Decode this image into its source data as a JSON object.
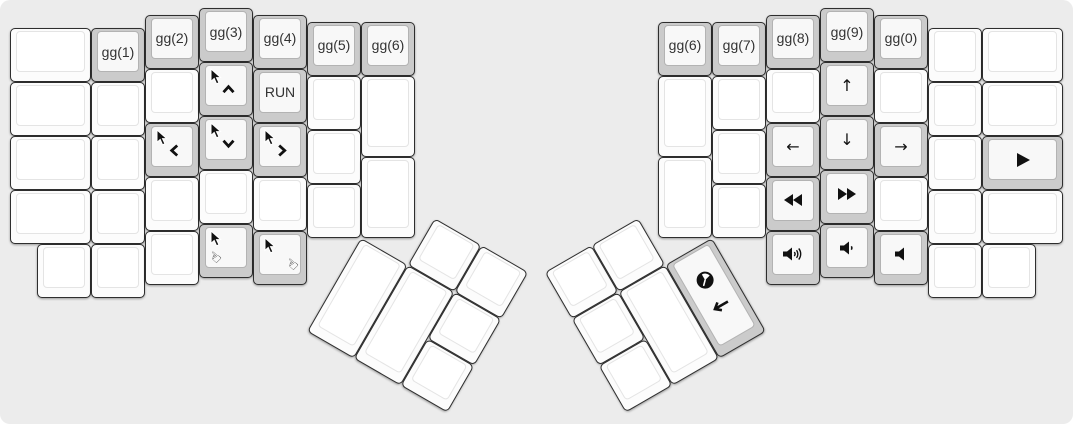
{
  "canvas": {
    "width": 1073,
    "height": 424,
    "background": "#ececec",
    "page_background": "#ffffff",
    "unit_px": 54,
    "origin_x": 10,
    "origin_y": 8,
    "colors": {
      "key_white": "#fcfcfc",
      "key_gray": "#cbcbcb",
      "key_border": "#2e2e2e",
      "legend": "#111111"
    }
  },
  "keys": [
    {
      "name": "blank",
      "x": 0,
      "y": 0.375,
      "w": 1.5,
      "color": "white"
    },
    {
      "name": "layer-gg1",
      "x": 1.5,
      "y": 0.375,
      "color": "gray",
      "label": "gg(1)"
    },
    {
      "name": "layer-gg2",
      "x": 2.5,
      "y": 0.125,
      "color": "gray",
      "label": "gg(2)"
    },
    {
      "name": "layer-gg3",
      "x": 3.5,
      "y": 0,
      "color": "gray",
      "label": "gg(3)"
    },
    {
      "name": "layer-gg4",
      "x": 4.5,
      "y": 0.125,
      "color": "gray",
      "label": "gg(4)"
    },
    {
      "name": "layer-gg5",
      "x": 5.5,
      "y": 0.25,
      "color": "gray",
      "label": "gg(5)"
    },
    {
      "name": "layer-gg6-left",
      "x": 6.5,
      "y": 0.25,
      "color": "gray",
      "label": "gg(6)"
    },
    {
      "name": "blank",
      "x": 0,
      "y": 1.375,
      "w": 1.5,
      "color": "white"
    },
    {
      "name": "blank",
      "x": 1.5,
      "y": 1.375,
      "color": "white"
    },
    {
      "name": "blank",
      "x": 2.5,
      "y": 1.125,
      "color": "white"
    },
    {
      "name": "mouse-up",
      "x": 3.5,
      "y": 1,
      "color": "gray",
      "legends": [
        {
          "icon": "mouse-cursor",
          "pos": "tl"
        },
        {
          "icon": "chevron-up",
          "pos": "mid"
        }
      ]
    },
    {
      "name": "run",
      "x": 4.5,
      "y": 1.125,
      "color": "gray",
      "label": "RUN"
    },
    {
      "name": "blank",
      "x": 5.5,
      "y": 1.25,
      "color": "white"
    },
    {
      "name": "blank",
      "x": 6.5,
      "y": 1.25,
      "h": 1.5,
      "color": "white"
    },
    {
      "name": "blank",
      "x": 0,
      "y": 2.375,
      "w": 1.5,
      "color": "white"
    },
    {
      "name": "blank",
      "x": 1.5,
      "y": 2.375,
      "color": "white"
    },
    {
      "name": "mouse-left",
      "x": 2.5,
      "y": 2.125,
      "color": "gray",
      "legends": [
        {
          "icon": "mouse-cursor",
          "pos": "tl"
        },
        {
          "icon": "chevron-left",
          "pos": "mid"
        }
      ]
    },
    {
      "name": "mouse-down",
      "x": 3.5,
      "y": 2,
      "color": "gray",
      "legends": [
        {
          "icon": "mouse-cursor",
          "pos": "tl"
        },
        {
          "icon": "chevron-down",
          "pos": "mid"
        }
      ]
    },
    {
      "name": "mouse-right",
      "x": 4.5,
      "y": 2.125,
      "color": "gray",
      "legends": [
        {
          "icon": "mouse-cursor",
          "pos": "tl"
        },
        {
          "icon": "chevron-right",
          "pos": "mid"
        }
      ]
    },
    {
      "name": "blank",
      "x": 5.5,
      "y": 2.25,
      "color": "white"
    },
    {
      "name": "blank",
      "x": 0,
      "y": 3.375,
      "w": 1.5,
      "color": "white"
    },
    {
      "name": "blank",
      "x": 1.5,
      "y": 3.375,
      "color": "white"
    },
    {
      "name": "blank",
      "x": 2.5,
      "y": 3.125,
      "color": "white"
    },
    {
      "name": "blank",
      "x": 3.5,
      "y": 3,
      "color": "white"
    },
    {
      "name": "blank",
      "x": 4.5,
      "y": 3.125,
      "color": "white"
    },
    {
      "name": "blank",
      "x": 5.5,
      "y": 3.25,
      "color": "white"
    },
    {
      "name": "blank",
      "x": 6.5,
      "y": 2.75,
      "h": 1.5,
      "color": "white"
    },
    {
      "name": "blank",
      "x": 0.5,
      "y": 4.375,
      "color": "white"
    },
    {
      "name": "blank",
      "x": 1.5,
      "y": 4.375,
      "color": "white"
    },
    {
      "name": "blank",
      "x": 2.5,
      "y": 4.125,
      "color": "white"
    },
    {
      "name": "mouse-button1",
      "x": 3.5,
      "y": 4,
      "color": "gray",
      "legends": [
        {
          "icon": "mouse-cursor",
          "pos": "tl"
        },
        {
          "icon": "hand-pointer",
          "pos": "bl"
        }
      ]
    },
    {
      "name": "mouse-button2",
      "x": 4.5,
      "y": 4.125,
      "color": "gray",
      "legends": [
        {
          "icon": "mouse-cursor",
          "pos": "tl"
        },
        {
          "icon": "hand-pointer",
          "pos": "br"
        }
      ]
    },
    {
      "name": "blank",
      "x": 7.5,
      "y": 3.25,
      "color": "white",
      "r": 30,
      "rx": 6.5,
      "ry": 4.25
    },
    {
      "name": "blank",
      "x": 8.5,
      "y": 3.25,
      "color": "white",
      "r": 30,
      "rx": 6.5,
      "ry": 4.25
    },
    {
      "name": "blank",
      "x": 6.5,
      "y": 4.25,
      "h": 2,
      "color": "white",
      "r": 30,
      "rx": 6.5,
      "ry": 4.25
    },
    {
      "name": "blank",
      "x": 7.5,
      "y": 4.25,
      "h": 2,
      "color": "white",
      "r": 30,
      "rx": 6.5,
      "ry": 4.25
    },
    {
      "name": "blank",
      "x": 8.5,
      "y": 4.25,
      "color": "white",
      "r": 30,
      "rx": 6.5,
      "ry": 4.25
    },
    {
      "name": "blank",
      "x": 8.5,
      "y": 5.25,
      "color": "white",
      "r": 30,
      "rx": 6.5,
      "ry": 4.25
    },
    {
      "name": "layer-gg6-right",
      "x": 12,
      "y": 0.25,
      "color": "gray",
      "label": "gg(6)"
    },
    {
      "name": "layer-gg7",
      "x": 13,
      "y": 0.25,
      "color": "gray",
      "label": "gg(7)"
    },
    {
      "name": "layer-gg8",
      "x": 14,
      "y": 0.125,
      "color": "gray",
      "label": "gg(8)"
    },
    {
      "name": "layer-gg9",
      "x": 15,
      "y": 0,
      "color": "gray",
      "label": "gg(9)"
    },
    {
      "name": "layer-gg0",
      "x": 16,
      "y": 0.125,
      "color": "gray",
      "label": "gg(0)"
    },
    {
      "name": "blank",
      "x": 17,
      "y": 0.375,
      "color": "white"
    },
    {
      "name": "blank",
      "x": 18,
      "y": 0.375,
      "w": 1.5,
      "color": "white"
    },
    {
      "name": "blank",
      "x": 12,
      "y": 1.25,
      "h": 1.5,
      "color": "white"
    },
    {
      "name": "blank",
      "x": 13,
      "y": 1.25,
      "color": "white"
    },
    {
      "name": "blank",
      "x": 14,
      "y": 1.125,
      "color": "white"
    },
    {
      "name": "arrow-up",
      "x": 15,
      "y": 1,
      "color": "gray",
      "icon": "arrow-up"
    },
    {
      "name": "blank",
      "x": 16,
      "y": 1.125,
      "color": "white"
    },
    {
      "name": "blank",
      "x": 17,
      "y": 1.375,
      "color": "white"
    },
    {
      "name": "blank",
      "x": 18,
      "y": 1.375,
      "w": 1.5,
      "color": "white"
    },
    {
      "name": "blank",
      "x": 13,
      "y": 2.25,
      "color": "white"
    },
    {
      "name": "arrow-left",
      "x": 14,
      "y": 2.125,
      "color": "gray",
      "icon": "arrow-left"
    },
    {
      "name": "arrow-down",
      "x": 15,
      "y": 2,
      "color": "gray",
      "icon": "arrow-down"
    },
    {
      "name": "arrow-right",
      "x": 16,
      "y": 2.125,
      "color": "gray",
      "icon": "arrow-right"
    },
    {
      "name": "blank",
      "x": 17,
      "y": 2.375,
      "color": "white"
    },
    {
      "name": "media-play",
      "x": 18,
      "y": 2.375,
      "w": 1.5,
      "color": "gray",
      "icon": "play"
    },
    {
      "name": "blank",
      "x": 12,
      "y": 2.75,
      "h": 1.5,
      "color": "white"
    },
    {
      "name": "blank",
      "x": 13,
      "y": 3.25,
      "color": "white"
    },
    {
      "name": "media-rewind",
      "x": 14,
      "y": 3.125,
      "color": "gray",
      "icon": "rewind"
    },
    {
      "name": "media-fast-forward",
      "x": 15,
      "y": 3,
      "color": "gray",
      "icon": "fast-forward"
    },
    {
      "name": "blank",
      "x": 16,
      "y": 3.125,
      "color": "white"
    },
    {
      "name": "blank",
      "x": 17,
      "y": 3.375,
      "color": "white"
    },
    {
      "name": "blank",
      "x": 18,
      "y": 3.375,
      "w": 1.5,
      "color": "white"
    },
    {
      "name": "volume-up",
      "x": 14,
      "y": 4.125,
      "color": "gray",
      "icon": "volume-up"
    },
    {
      "name": "volume-down",
      "x": 15,
      "y": 4,
      "color": "gray",
      "icon": "volume-down"
    },
    {
      "name": "volume-mute",
      "x": 16,
      "y": 4.125,
      "color": "gray",
      "icon": "volume-mute"
    },
    {
      "name": "blank",
      "x": 17,
      "y": 4.375,
      "color": "white"
    },
    {
      "name": "blank",
      "x": 18,
      "y": 4.375,
      "color": "white"
    },
    {
      "name": "blank",
      "x": 10,
      "y": 3.25,
      "color": "white",
      "r": -30,
      "rx": 13,
      "ry": 4.25
    },
    {
      "name": "blank",
      "x": 11,
      "y": 3.25,
      "color": "white",
      "r": -30,
      "rx": 13,
      "ry": 4.25
    },
    {
      "name": "blank",
      "x": 10,
      "y": 4.25,
      "color": "white",
      "r": -30,
      "rx": 13,
      "ry": 4.25
    },
    {
      "name": "blank",
      "x": 11,
      "y": 4.25,
      "h": 2,
      "color": "white",
      "r": -30,
      "rx": 13,
      "ry": 4.25
    },
    {
      "name": "clock-return",
      "x": 12,
      "y": 4.25,
      "h": 2,
      "color": "gray",
      "r": -30,
      "rx": 13,
      "ry": 4.25,
      "legends": [
        {
          "icon": "clock",
          "pos": "uc"
        },
        {
          "icon": "return-arrow",
          "pos": "lc"
        }
      ]
    },
    {
      "name": "blank",
      "x": 10,
      "y": 5.25,
      "color": "white",
      "r": -30,
      "rx": 13,
      "ry": 4.25
    }
  ]
}
